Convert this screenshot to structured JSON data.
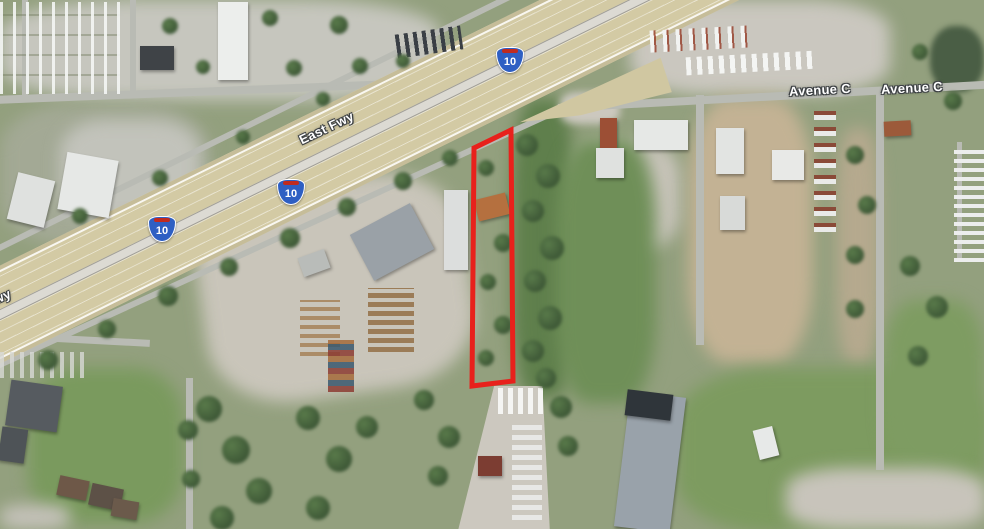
{
  "map": {
    "description": "Aerial satellite view of the East Freeway (I-10) corridor near Avenue C with a highlighted parcel",
    "labels": {
      "east_fwy": "East Fwy",
      "east_fwy_partial": "wy",
      "avenue_c_east": "Avenue C",
      "avenue_c_far_east": "Avenue C"
    },
    "shields": [
      {
        "system": "interstate",
        "number": "10"
      },
      {
        "system": "interstate",
        "number": "10"
      },
      {
        "system": "interstate",
        "number": "10"
      }
    ],
    "shield_colors": {
      "blue": "#2e5fc3",
      "red": "#bf2b20",
      "outline": "#ffffff"
    },
    "parcel": {
      "points": "474,148 511,130 513,381 472,386",
      "stroke_color": "#e8211c"
    },
    "palette": {
      "terrain_green": "#93a07e",
      "highway_pavement": "#d3caa4",
      "road_gray": "#b9bbb4",
      "label_text": "#ffffff"
    }
  }
}
